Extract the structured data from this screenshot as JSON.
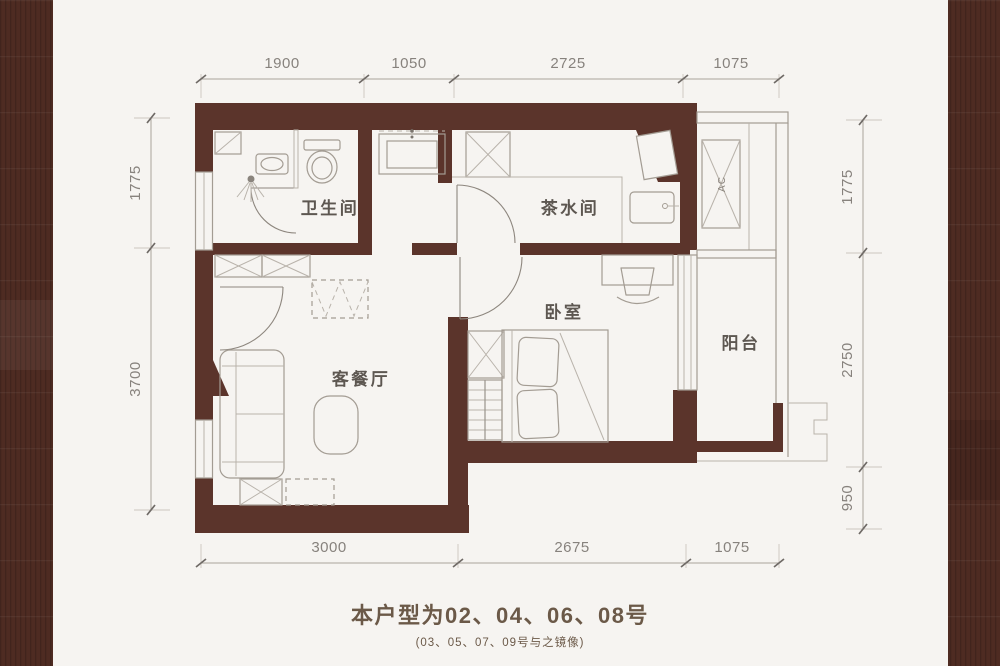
{
  "footer": {
    "line1": "本户型为02、04、06、08号",
    "line2": "(03、05、07、09号与之镜像)"
  },
  "rooms": {
    "bathroom": "卫生间",
    "pantry": "茶水间",
    "bedroom": "卧室",
    "living_dining": "客餐厅",
    "balcony": "阳台",
    "ac_platform": "AC"
  },
  "dimensions": {
    "top": [
      "1900",
      "1050",
      "2725",
      "1075"
    ],
    "bottom": [
      "3000",
      "2675",
      "1075"
    ],
    "left": [
      "1775",
      "3700"
    ],
    "right": [
      "1775",
      "2750",
      "950"
    ]
  },
  "colors": {
    "wall": "#5b342b",
    "frame_band": "#4e2b22",
    "paper": "#f6f4f1",
    "dim_text": "#87827d",
    "label_text": "#5d5751",
    "footer_text": "#6b5948"
  }
}
